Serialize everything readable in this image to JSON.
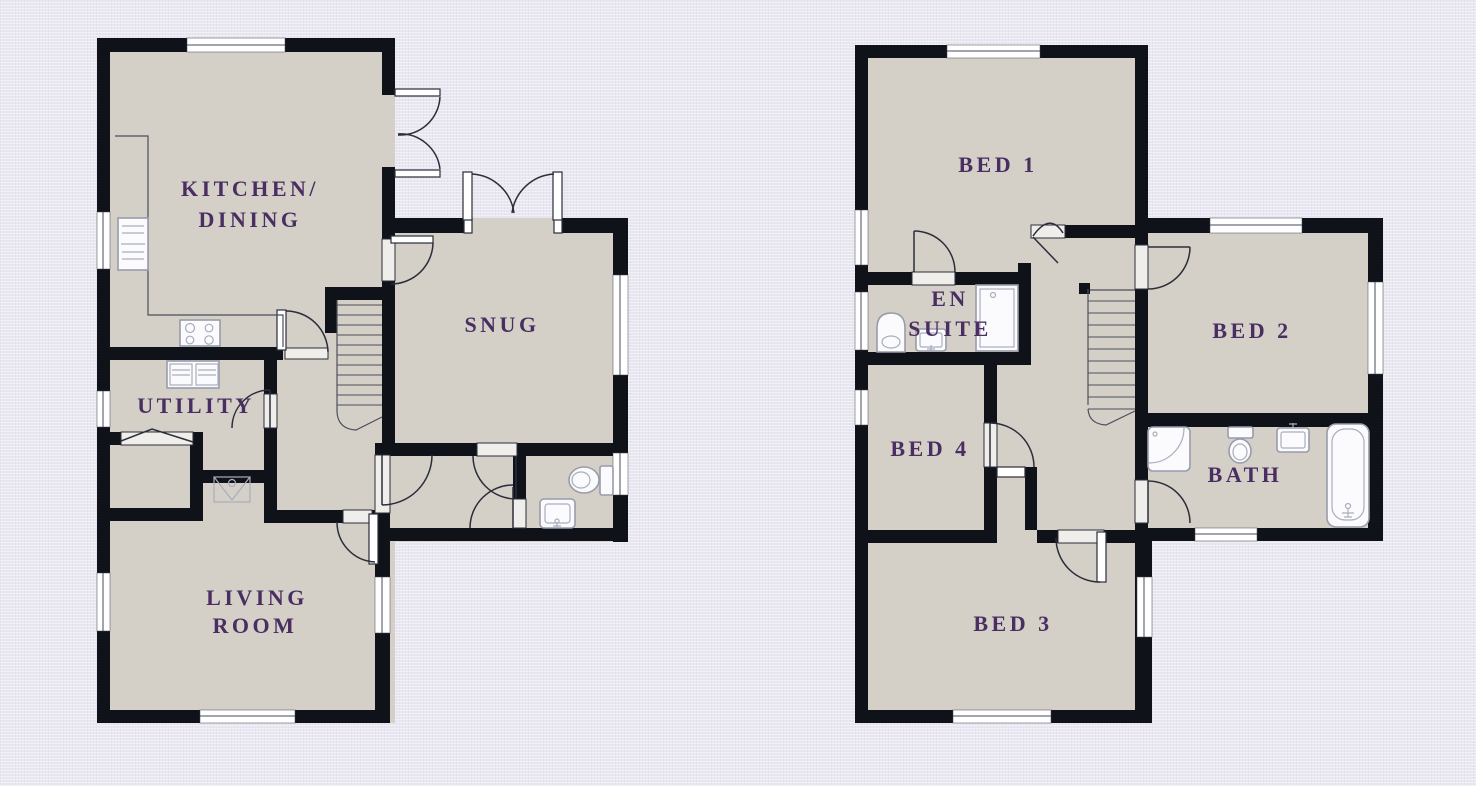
{
  "document": {
    "type": "floor-plan",
    "floor_count": 2
  },
  "palette": {
    "background": "#e9e8f1",
    "room_fill": "#d4d0c8",
    "wall": "#10121a",
    "label_text": "#4a2e61",
    "door_line": "#2b2d3a",
    "fixture_line": "#989cab",
    "window_fill": "#ffffff"
  },
  "ground_floor": {
    "rooms": {
      "kitchen_dining": {
        "line1": "KITCHEN/",
        "line2": "DINING"
      },
      "snug": {
        "line1": "SNUG"
      },
      "utility": {
        "line1": "UTILITY"
      },
      "living_room": {
        "line1": "LIVING",
        "line2": "ROOM"
      }
    },
    "fixtures": [
      "stairs",
      "kitchen-counter",
      "hob",
      "tall-appliance",
      "utility-appliances",
      "wc-toilet",
      "wc-basin",
      "store-cupboard",
      "front-door",
      "french-doors-kitchen",
      "french-doors-snug"
    ]
  },
  "first_floor": {
    "rooms": {
      "bed1": {
        "line1": "BED 1"
      },
      "en_suite": {
        "line1": "EN",
        "line2": "SUITE"
      },
      "bed2": {
        "line1": "BED 2"
      },
      "bed4": {
        "line1": "BED 4"
      },
      "bath": {
        "line1": "BATH"
      },
      "bed3": {
        "line1": "BED 3"
      }
    },
    "fixtures": [
      "stairs",
      "en-suite-shower",
      "en-suite-toilet",
      "en-suite-basin",
      "corner-shower",
      "bath-toilet",
      "bath-basin",
      "bathtub",
      "landing-cupboard"
    ]
  }
}
